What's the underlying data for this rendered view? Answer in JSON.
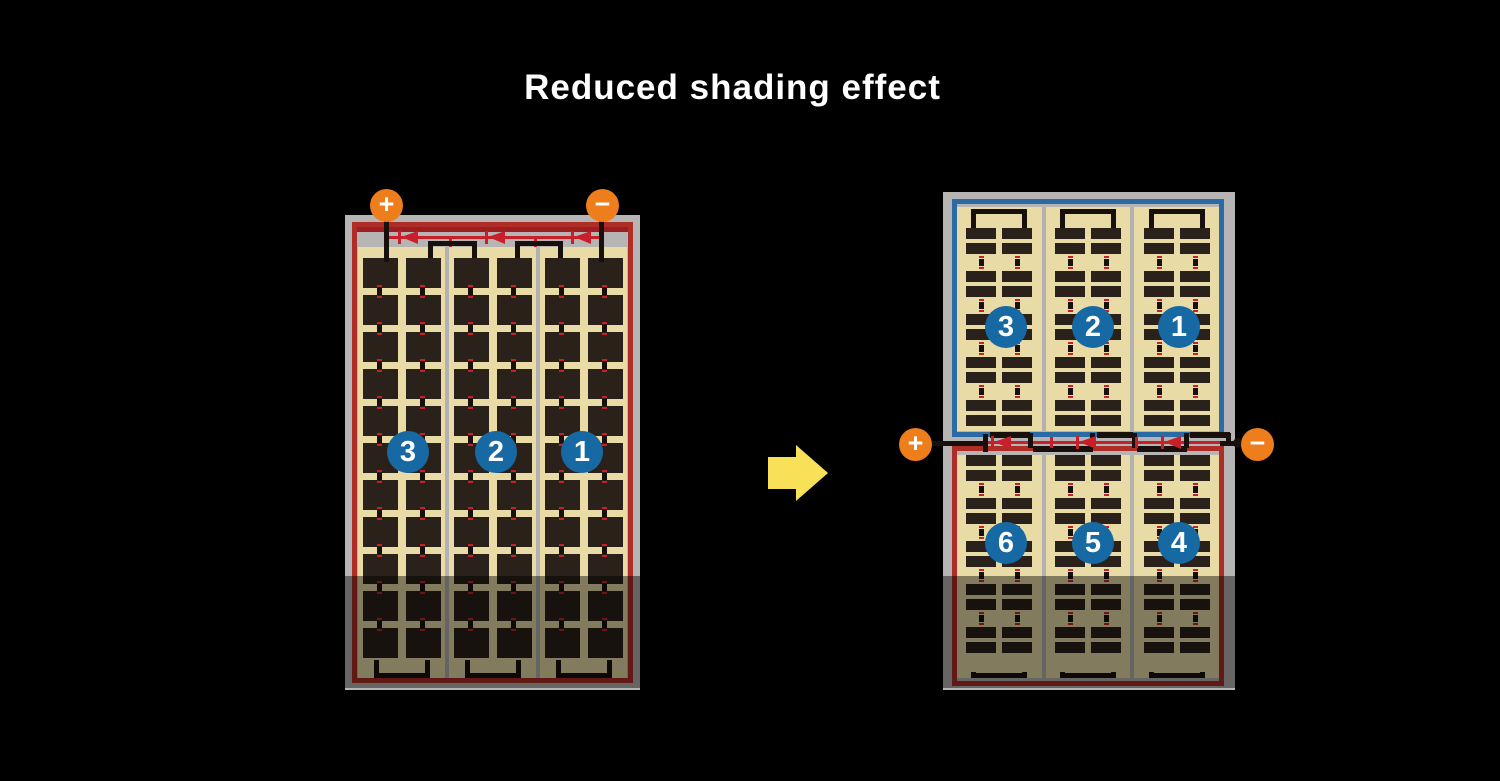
{
  "title": "Reduced shading effect",
  "arrow_icon": "transform-right-arrow",
  "left_panel": {
    "name": "conventional full-cell module",
    "terminal_positive": "+",
    "terminal_negative": "−",
    "string_labels": [
      "3",
      "2",
      "1"
    ],
    "string_count": 3,
    "cell_rows": 11,
    "cell_columns_per_string": 2,
    "bypass_diode_count": 3,
    "border_color": "#ae2d27"
  },
  "right_panel": {
    "name": "half-cut-cell module",
    "terminal_positive": "+",
    "terminal_negative": "−",
    "top_string_labels": [
      "3",
      "2",
      "1"
    ],
    "bottom_string_labels": [
      "6",
      "5",
      "4"
    ],
    "string_count": 3,
    "half_cell_pairs_per_half": 5,
    "bypass_diode_count": 3,
    "top_border_color": "#2b6ba5",
    "bottom_border_color": "#ae2d27"
  },
  "colors": {
    "background": "#000000",
    "frame_gray": "#b6b5b3",
    "cell_dark": "#2b211b",
    "cell_field_cream": "#e8dba6",
    "diode_red": "#c8202a",
    "bus_dark_red": "#9e1d21",
    "terminal_orange": "#ee7d1c",
    "circle_blue": "#1769a4",
    "arrow_yellow": "#f8e159",
    "shade": "rgba(0,0,0,0.44)"
  }
}
